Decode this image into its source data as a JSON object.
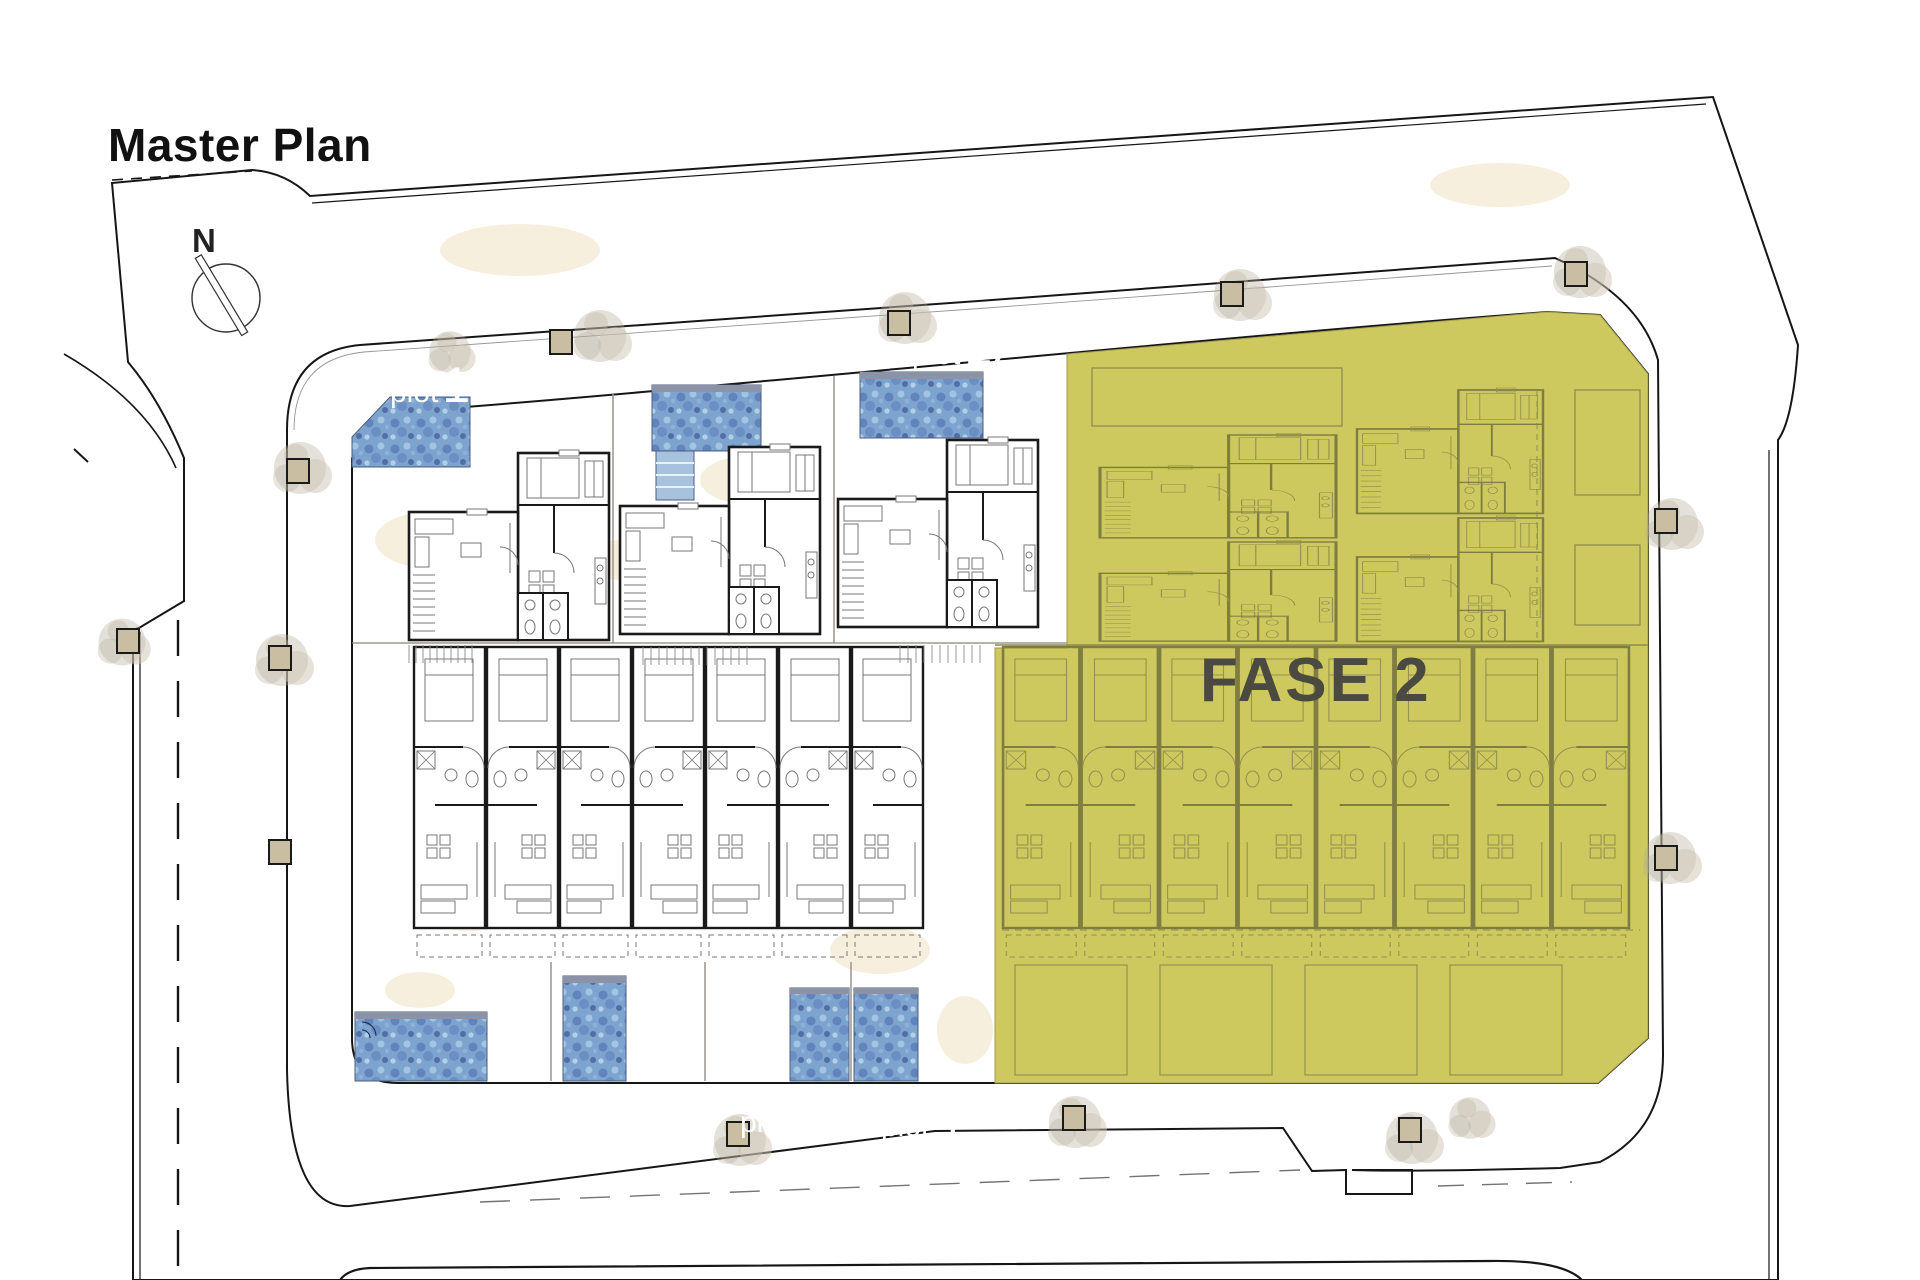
{
  "title": "Master Plan",
  "compass": {
    "label": "N"
  },
  "phase": {
    "label": "FASE 2"
  },
  "plot_labels": [
    {
      "word": "plot",
      "number": "14"
    },
    {
      "word": "plot",
      "number": "13"
    },
    {
      "word": "plot",
      "number": "12"
    },
    {
      "word": "plot",
      "number": "1"
    },
    {
      "word": "plot",
      "number": "2"
    },
    {
      "word": "plot",
      "number": "3"
    },
    {
      "word": "plot",
      "number": "4"
    }
  ],
  "colors": {
    "background": "#ffffff",
    "parcel": "#ece3d6",
    "road": "#b3ab9a",
    "block": "#fcf6e7",
    "sand": "#f0e0bd",
    "pool_base": "#7da4cf",
    "phase_fill": "#cdc95e",
    "phase_line": "#8f8c4d",
    "wall": "#161616",
    "label": "#ffffff",
    "phase_text": "#4b4a40",
    "title_text": "#111111"
  }
}
